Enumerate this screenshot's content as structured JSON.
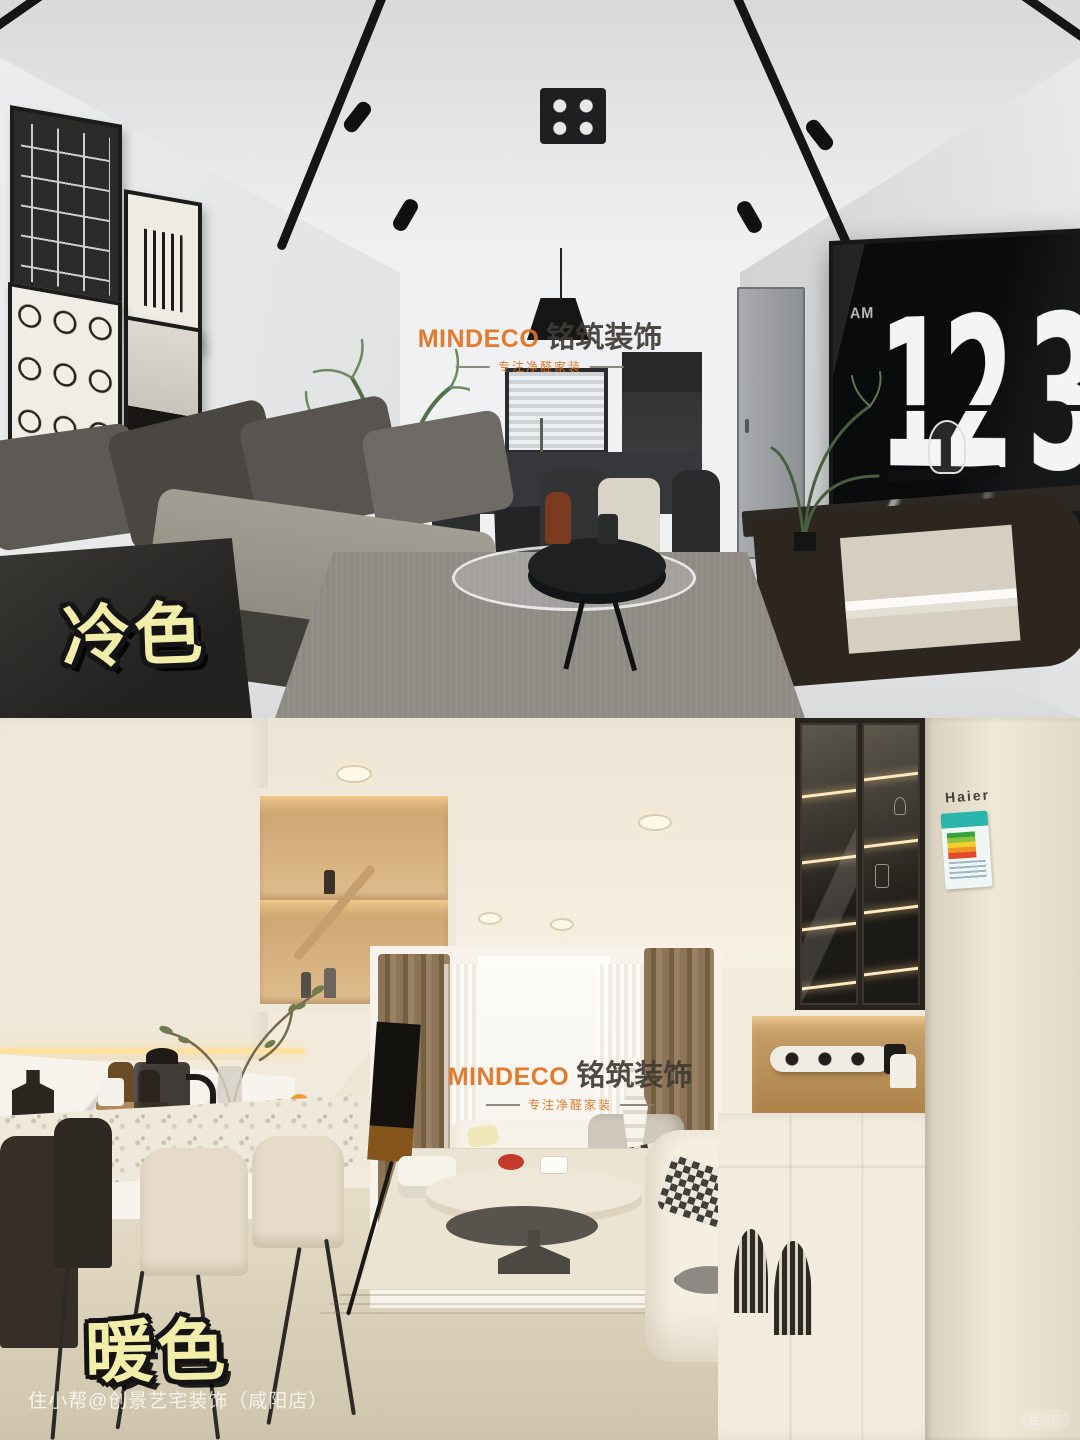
{
  "meta": {
    "width": 1080,
    "height": 1440
  },
  "watermark": {
    "brand_en": "MINDECO",
    "brand_cn": "铭筑装饰",
    "tagline": "专注净醛家装",
    "accent_color": "#e2711f",
    "cn_color": "#3f3b36"
  },
  "panels": {
    "cool": {
      "label": "冷色",
      "clock": {
        "meridiem": "AM",
        "hours": "12",
        "minutes": "34"
      }
    },
    "warm": {
      "label": "暖色",
      "fridge_brand": "Haier"
    }
  },
  "label_style": {
    "fill": "#f2eda9",
    "outline": "#141414"
  },
  "caption": {
    "text": "住小帮@创景艺宅装饰（咸阳店）"
  },
  "corner_badge": {
    "text": "住小帮"
  }
}
